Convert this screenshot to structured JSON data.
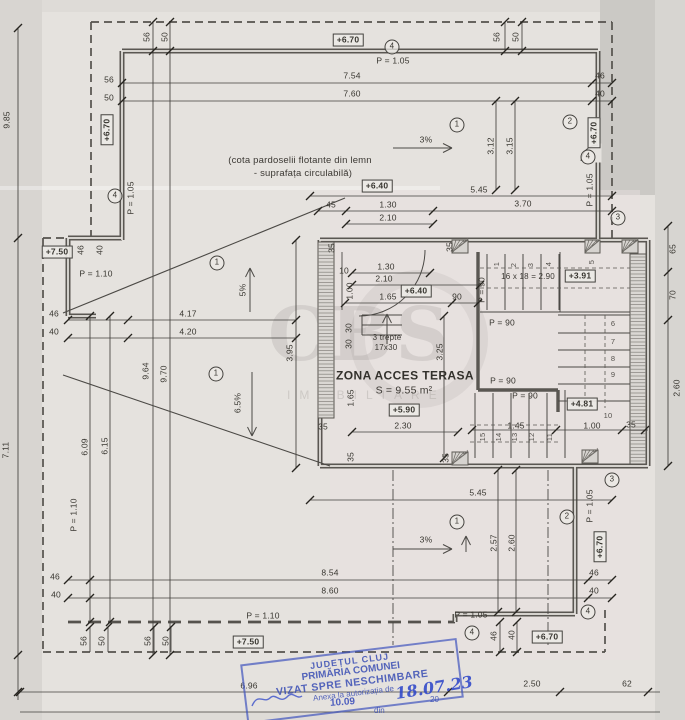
{
  "page": {
    "watermark": {
      "line1": "CBS",
      "line2": "IMOBILIARE"
    },
    "stamp": {
      "line1": "JUDEȚUL CLUJ",
      "line2": "PRIMĂRIA COMUNEI",
      "line3": "VIZAT SPRE NESCHIMBARE",
      "line4": "Anexa la autorizația de",
      "word_din": "din",
      "year_prefix": "20",
      "date_handwritten": "18.07.23",
      "number_handwritten": "10.09"
    },
    "labels": [
      {
        "t": "56",
        "x": 147,
        "y": 37,
        "r": -90,
        "c": "dim"
      },
      {
        "t": "50",
        "x": 165,
        "y": 37,
        "r": -90,
        "c": "dim"
      },
      {
        "t": "56",
        "x": 497,
        "y": 37,
        "r": -90,
        "c": "dim"
      },
      {
        "t": "50",
        "x": 516,
        "y": 37,
        "r": -90,
        "c": "dim"
      },
      {
        "t": "+6.70",
        "x": 348,
        "y": 40,
        "c": "box"
      },
      {
        "t": "4",
        "x": 392,
        "y": 47,
        "c": "circle"
      },
      {
        "t": "P = 1.05",
        "x": 393,
        "y": 61,
        "c": "dim"
      },
      {
        "t": "56",
        "x": 109,
        "y": 80,
        "c": "dim"
      },
      {
        "t": "50",
        "x": 109,
        "y": 98,
        "c": "dim"
      },
      {
        "t": "7.54",
        "x": 352,
        "y": 76,
        "c": "dim"
      },
      {
        "t": "7.60",
        "x": 352,
        "y": 94,
        "c": "dim"
      },
      {
        "t": "46",
        "x": 600,
        "y": 76,
        "c": "dim"
      },
      {
        "t": "40",
        "x": 600,
        "y": 94,
        "c": "dim"
      },
      {
        "t": "9.85",
        "x": 7,
        "y": 120,
        "r": -90,
        "c": "dim"
      },
      {
        "t": "+6.70",
        "x": 107,
        "y": 130,
        "r": -90,
        "c": "box"
      },
      {
        "t": "1",
        "x": 457,
        "y": 125,
        "c": "circle"
      },
      {
        "t": "2",
        "x": 570,
        "y": 122,
        "c": "circle"
      },
      {
        "t": "3%",
        "x": 426,
        "y": 140,
        "c": "dim"
      },
      {
        "t": "3.12",
        "x": 491,
        "y": 146,
        "r": -90,
        "c": "dim"
      },
      {
        "t": "3.15",
        "x": 510,
        "y": 146,
        "r": -90,
        "c": "dim"
      },
      {
        "t": "+6.70",
        "x": 594,
        "y": 133,
        "r": -90,
        "c": "box"
      },
      {
        "t": "4",
        "x": 588,
        "y": 157,
        "c": "circle"
      },
      {
        "t": "P = 1.05",
        "x": 590,
        "y": 190,
        "r": -90,
        "c": "dim"
      },
      {
        "t": "(cota pardoselii flotante din lemn",
        "x": 300,
        "y": 161,
        "c": "note"
      },
      {
        "t": "- suprafața circulabilă)",
        "x": 303,
        "y": 174,
        "c": "note"
      },
      {
        "t": "+6.40",
        "x": 377,
        "y": 186,
        "c": "box"
      },
      {
        "t": "4",
        "x": 115,
        "y": 196,
        "c": "circle"
      },
      {
        "t": "P = 1.05",
        "x": 131,
        "y": 198,
        "r": -90,
        "c": "dim"
      },
      {
        "t": "5.45",
        "x": 479,
        "y": 190,
        "c": "dim"
      },
      {
        "t": "45",
        "x": 331,
        "y": 205,
        "c": "dim"
      },
      {
        "t": "1.30",
        "x": 388,
        "y": 205,
        "c": "dim"
      },
      {
        "t": "3.70",
        "x": 523,
        "y": 204,
        "c": "dim"
      },
      {
        "t": "2.10",
        "x": 388,
        "y": 218,
        "c": "dim"
      },
      {
        "t": "3",
        "x": 618,
        "y": 218,
        "c": "circle"
      },
      {
        "t": "+7.50",
        "x": 57,
        "y": 252,
        "c": "box"
      },
      {
        "t": "46",
        "x": 81,
        "y": 250,
        "r": -90,
        "c": "dim"
      },
      {
        "t": "40",
        "x": 100,
        "y": 250,
        "r": -90,
        "c": "dim"
      },
      {
        "t": "P = 1.10",
        "x": 96,
        "y": 274,
        "c": "dim"
      },
      {
        "t": "1",
        "x": 217,
        "y": 263,
        "c": "circle"
      },
      {
        "t": "5%",
        "x": 243,
        "y": 290,
        "r": -90,
        "c": "dim"
      },
      {
        "t": "35",
        "x": 332,
        "y": 248,
        "r": -90,
        "c": "dim"
      },
      {
        "t": "35",
        "x": 450,
        "y": 247,
        "r": -90,
        "c": "dim"
      },
      {
        "t": "10",
        "x": 344,
        "y": 271,
        "c": "dim"
      },
      {
        "t": "1.30",
        "x": 386,
        "y": 267,
        "c": "dim"
      },
      {
        "t": "2.10",
        "x": 384,
        "y": 279,
        "c": "dim"
      },
      {
        "t": "1.00",
        "x": 350,
        "y": 291,
        "r": -90,
        "c": "dim"
      },
      {
        "t": "1.65",
        "x": 388,
        "y": 297,
        "c": "dim"
      },
      {
        "t": "+6.40",
        "x": 416,
        "y": 291,
        "c": "box"
      },
      {
        "t": "90",
        "x": 457,
        "y": 297,
        "c": "dim"
      },
      {
        "t": "P = 90",
        "x": 482,
        "y": 290,
        "r": -90,
        "c": "dim"
      },
      {
        "t": "1",
        "x": 497,
        "y": 264,
        "r": -90,
        "c": "step"
      },
      {
        "t": "2",
        "x": 514,
        "y": 265,
        "r": -90,
        "c": "step"
      },
      {
        "t": "3",
        "x": 531,
        "y": 265,
        "r": -90,
        "c": "step"
      },
      {
        "t": "4",
        "x": 549,
        "y": 264,
        "r": -90,
        "c": "step"
      },
      {
        "t": "5",
        "x": 592,
        "y": 262,
        "r": -90,
        "c": "step"
      },
      {
        "t": "16 x 18 = 2.90",
        "x": 528,
        "y": 277,
        "c": "small"
      },
      {
        "t": "+3.91",
        "x": 580,
        "y": 276,
        "c": "box"
      },
      {
        "t": "P = 90",
        "x": 502,
        "y": 323,
        "c": "dim"
      },
      {
        "t": "65",
        "x": 673,
        "y": 249,
        "r": -90,
        "c": "dim"
      },
      {
        "t": "70",
        "x": 673,
        "y": 295,
        "r": -90,
        "c": "dim"
      },
      {
        "t": "6",
        "x": 613,
        "y": 324,
        "c": "step"
      },
      {
        "t": "7",
        "x": 613,
        "y": 342,
        "c": "step"
      },
      {
        "t": "8",
        "x": 613,
        "y": 359,
        "c": "step"
      },
      {
        "t": "9",
        "x": 613,
        "y": 375,
        "c": "step"
      },
      {
        "t": "10",
        "x": 608,
        "y": 416,
        "c": "step"
      },
      {
        "t": "3.25",
        "x": 440,
        "y": 352,
        "r": -90,
        "c": "dim"
      },
      {
        "t": "30",
        "x": 349,
        "y": 328,
        "r": -90,
        "c": "dim"
      },
      {
        "t": "30",
        "x": 349,
        "y": 344,
        "r": -90,
        "c": "dim"
      },
      {
        "t": "3 trepte",
        "x": 387,
        "y": 338,
        "c": "small"
      },
      {
        "t": "17x30",
        "x": 386,
        "y": 348,
        "c": "small"
      },
      {
        "t": "4.17",
        "x": 188,
        "y": 314,
        "c": "dim"
      },
      {
        "t": "4.20",
        "x": 188,
        "y": 332,
        "c": "dim"
      },
      {
        "t": "46",
        "x": 54,
        "y": 314,
        "c": "dim"
      },
      {
        "t": "40",
        "x": 54,
        "y": 332,
        "c": "dim"
      },
      {
        "t": "1",
        "x": 216,
        "y": 374,
        "c": "circle"
      },
      {
        "t": "6.5%",
        "x": 238,
        "y": 403,
        "r": -90,
        "c": "dim"
      },
      {
        "t": "9.64",
        "x": 146,
        "y": 371,
        "r": -90,
        "c": "dim"
      },
      {
        "t": "9.70",
        "x": 164,
        "y": 374,
        "r": -90,
        "c": "dim"
      },
      {
        "t": "3.95",
        "x": 290,
        "y": 353,
        "r": -90,
        "c": "dim"
      },
      {
        "t": "ZONA ACCES TERASA",
        "x": 405,
        "y": 376,
        "c": "title"
      },
      {
        "t": "S = 9.55 m²",
        "x": 404,
        "y": 391,
        "c": "area"
      },
      {
        "t": "+5.90",
        "x": 404,
        "y": 410,
        "c": "box"
      },
      {
        "t": "1.65",
        "x": 351,
        "y": 398,
        "r": -90,
        "c": "dim"
      },
      {
        "t": "35",
        "x": 323,
        "y": 427,
        "c": "dim"
      },
      {
        "t": "2.30",
        "x": 403,
        "y": 426,
        "c": "dim"
      },
      {
        "t": "35",
        "x": 351,
        "y": 457,
        "r": -90,
        "c": "dim"
      },
      {
        "t": "35",
        "x": 446,
        "y": 458,
        "r": -90,
        "c": "dim"
      },
      {
        "t": "P = 90",
        "x": 503,
        "y": 381,
        "c": "dim"
      },
      {
        "t": "P = 90",
        "x": 525,
        "y": 396,
        "c": "dim"
      },
      {
        "t": "+4.81",
        "x": 582,
        "y": 404,
        "c": "box"
      },
      {
        "t": "1.45",
        "x": 516,
        "y": 426,
        "c": "dim"
      },
      {
        "t": "1.00",
        "x": 592,
        "y": 426,
        "c": "dim"
      },
      {
        "t": "35",
        "x": 631,
        "y": 425,
        "c": "dim"
      },
      {
        "t": "11",
        "x": 550,
        "y": 437,
        "r": -90,
        "c": "step"
      },
      {
        "t": "12",
        "x": 532,
        "y": 437,
        "r": -90,
        "c": "step"
      },
      {
        "t": "13",
        "x": 515,
        "y": 437,
        "r": -90,
        "c": "step"
      },
      {
        "t": "14",
        "x": 499,
        "y": 437,
        "r": -90,
        "c": "step"
      },
      {
        "t": "15",
        "x": 483,
        "y": 437,
        "r": -90,
        "c": "step"
      },
      {
        "t": "2.60",
        "x": 677,
        "y": 388,
        "r": -90,
        "c": "dim"
      },
      {
        "t": "6.09",
        "x": 85,
        "y": 447,
        "r": -90,
        "c": "dim"
      },
      {
        "t": "6.15",
        "x": 105,
        "y": 446,
        "r": -90,
        "c": "dim"
      },
      {
        "t": "7.11",
        "x": 6,
        "y": 450,
        "r": -90,
        "c": "dim"
      },
      {
        "t": "P = 1.10",
        "x": 74,
        "y": 515,
        "r": -90,
        "c": "dim"
      },
      {
        "t": "5.45",
        "x": 478,
        "y": 493,
        "c": "dim"
      },
      {
        "t": "1",
        "x": 457,
        "y": 522,
        "c": "circle"
      },
      {
        "t": "2",
        "x": 567,
        "y": 517,
        "c": "circle"
      },
      {
        "t": "3",
        "x": 612,
        "y": 480,
        "c": "circle"
      },
      {
        "t": "3%",
        "x": 426,
        "y": 540,
        "c": "dim"
      },
      {
        "t": "2.57",
        "x": 494,
        "y": 543,
        "r": -90,
        "c": "dim"
      },
      {
        "t": "2.60",
        "x": 512,
        "y": 543,
        "r": -90,
        "c": "dim"
      },
      {
        "t": "P = 1.05",
        "x": 590,
        "y": 506,
        "r": -90,
        "c": "dim"
      },
      {
        "t": "+6.70",
        "x": 600,
        "y": 547,
        "r": -90,
        "c": "box"
      },
      {
        "t": "46",
        "x": 594,
        "y": 573,
        "c": "dim"
      },
      {
        "t": "40",
        "x": 594,
        "y": 591,
        "c": "dim"
      },
      {
        "t": "8.54",
        "x": 330,
        "y": 573,
        "c": "dim"
      },
      {
        "t": "8.60",
        "x": 330,
        "y": 591,
        "c": "dim"
      },
      {
        "t": "46",
        "x": 55,
        "y": 577,
        "c": "dim"
      },
      {
        "t": "40",
        "x": 56,
        "y": 595,
        "c": "dim"
      },
      {
        "t": "P = 1.10",
        "x": 263,
        "y": 616,
        "c": "dim"
      },
      {
        "t": "P = 1.05",
        "x": 471,
        "y": 615,
        "c": "dim"
      },
      {
        "t": "4",
        "x": 588,
        "y": 612,
        "c": "circle"
      },
      {
        "t": "4",
        "x": 472,
        "y": 633,
        "c": "circle"
      },
      {
        "t": "46",
        "x": 494,
        "y": 636,
        "r": -90,
        "c": "dim"
      },
      {
        "t": "40",
        "x": 512,
        "y": 635,
        "r": -90,
        "c": "dim"
      },
      {
        "t": "+6.70",
        "x": 547,
        "y": 637,
        "c": "box"
      },
      {
        "t": "+7.50",
        "x": 248,
        "y": 642,
        "c": "box"
      },
      {
        "t": "56",
        "x": 84,
        "y": 641,
        "r": -90,
        "c": "dim"
      },
      {
        "t": "50",
        "x": 102,
        "y": 641,
        "r": -90,
        "c": "dim"
      },
      {
        "t": "56",
        "x": 148,
        "y": 641,
        "r": -90,
        "c": "dim"
      },
      {
        "t": "50",
        "x": 166,
        "y": 641,
        "r": -90,
        "c": "dim"
      },
      {
        "t": "6.96",
        "x": 249,
        "y": 686,
        "c": "dim"
      },
      {
        "t": "2.50",
        "x": 532,
        "y": 684,
        "c": "dim"
      },
      {
        "t": "62",
        "x": 627,
        "y": 684,
        "c": "dim"
      }
    ]
  }
}
